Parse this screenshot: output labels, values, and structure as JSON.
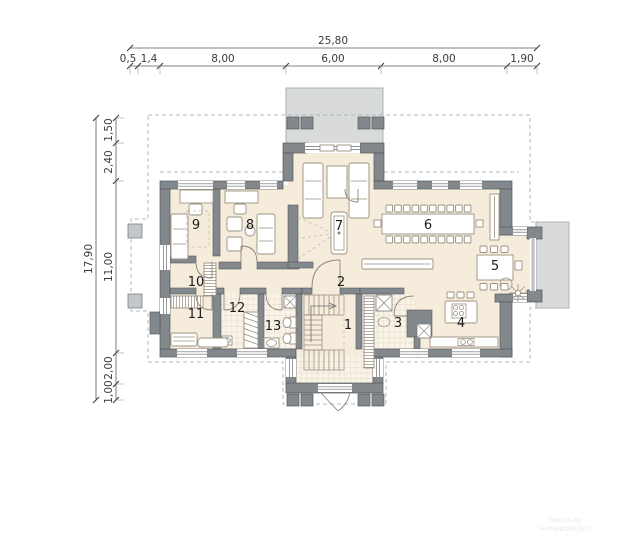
{
  "dims": {
    "top": {
      "total": "25,80",
      "segments": [
        "0,5",
        "1,4",
        "8,00",
        "6,00",
        "8,00",
        "1,90"
      ]
    },
    "left": {
      "total": "17,90",
      "segments": [
        "1,50",
        "2,40",
        "11,00",
        "2,00",
        "1,00"
      ]
    }
  },
  "rooms": [
    {
      "label": "1"
    },
    {
      "label": "2"
    },
    {
      "label": "3"
    },
    {
      "label": "4"
    },
    {
      "label": "5"
    },
    {
      "label": "6"
    },
    {
      "label": "7"
    },
    {
      "label": "8"
    },
    {
      "label": "9"
    },
    {
      "label": "10"
    },
    {
      "label": "11"
    },
    {
      "label": "12"
    },
    {
      "label": "13"
    }
  ],
  "watermark": {
    "line1": "Design by",
    "line2": "HOMEKONCEPT"
  },
  "colors": {
    "floor": "#f5ecdc",
    "tile": "#faf4e8",
    "tile_grid": "#e2d9c5",
    "wall": "#83888d",
    "wall_outline": "#55595d",
    "terrace": "#d9dbda",
    "dashed": "#b3b7b9",
    "furniture_outline": "#9b9282",
    "dimension_text": "#3b3b3b",
    "room_label": "#1d1d1d",
    "watermark": "#e8e8e5"
  }
}
